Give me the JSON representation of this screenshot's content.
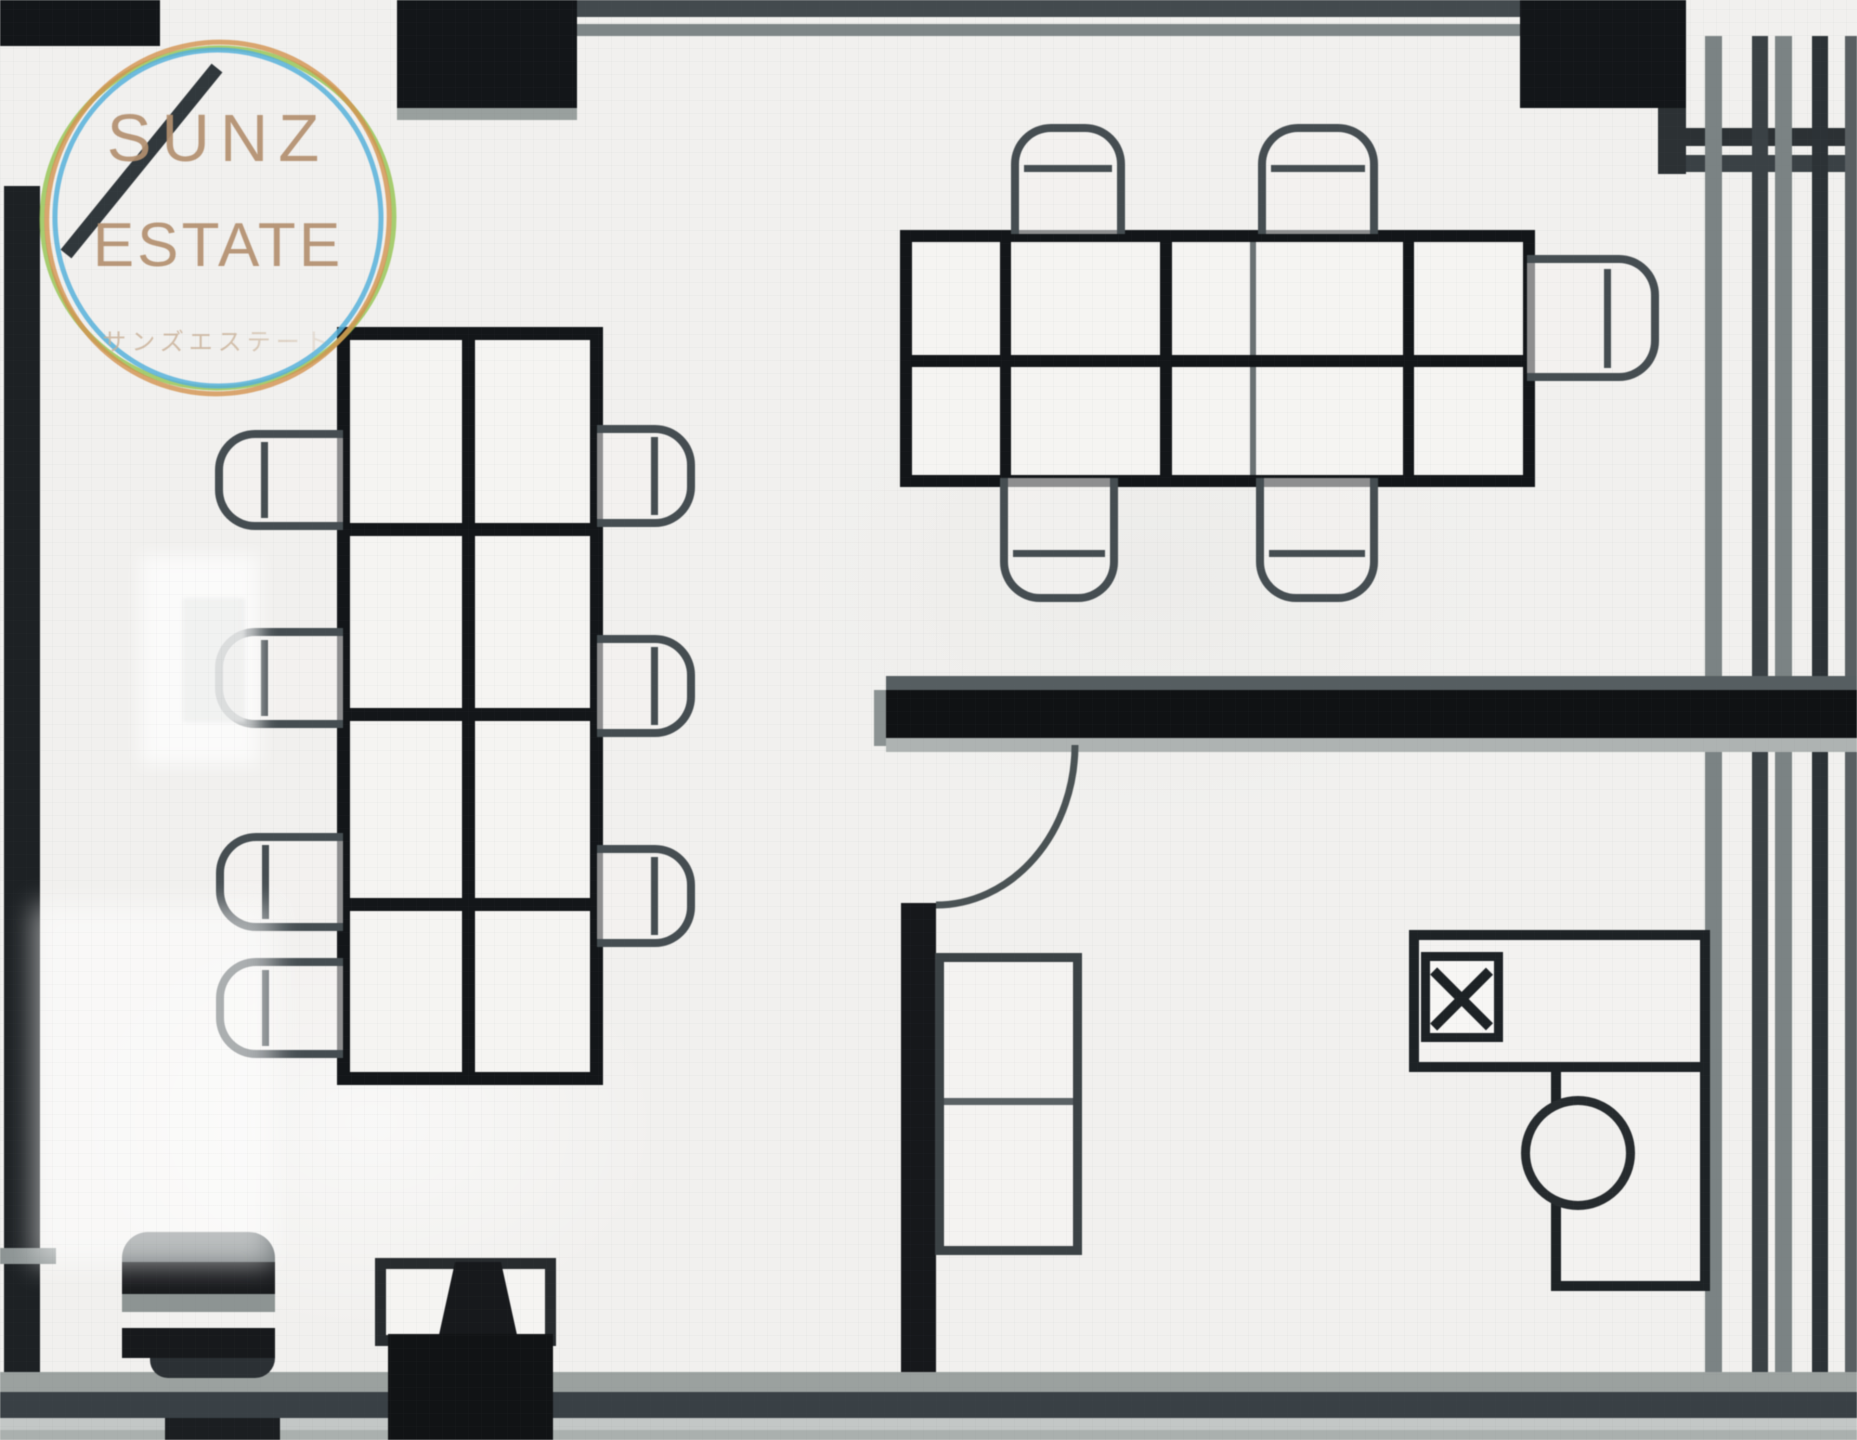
{
  "meta": {
    "kind": "real-estate floor plan",
    "style": "black-line architectural drawing, low-res upscaled"
  },
  "watermark": {
    "brand_line1": "SUNZ",
    "brand_line2": "ESTATE",
    "brand_katakana": "サンズエステート"
  },
  "palette": {
    "floor": "#f1f0ee",
    "wall-black": "#131619",
    "wall-dark": "#394045",
    "wall-gray": "#7b8384",
    "wall-light": "#aeb3b2",
    "line": "#454d51",
    "logo-text": "#b4906f",
    "ring-green": "#93c44f",
    "ring-blue": "#57b1da",
    "ring-orange": "#d3924f"
  },
  "furniture": {
    "left_desk_cluster": {
      "desks": 8,
      "chairs": 7
    },
    "right_desk_cluster": {
      "desks": 10,
      "chairs": 5
    },
    "storage_shelf_compartments": 2,
    "l_shaped_desk": 1,
    "round_stool": 1,
    "doors": 2
  }
}
